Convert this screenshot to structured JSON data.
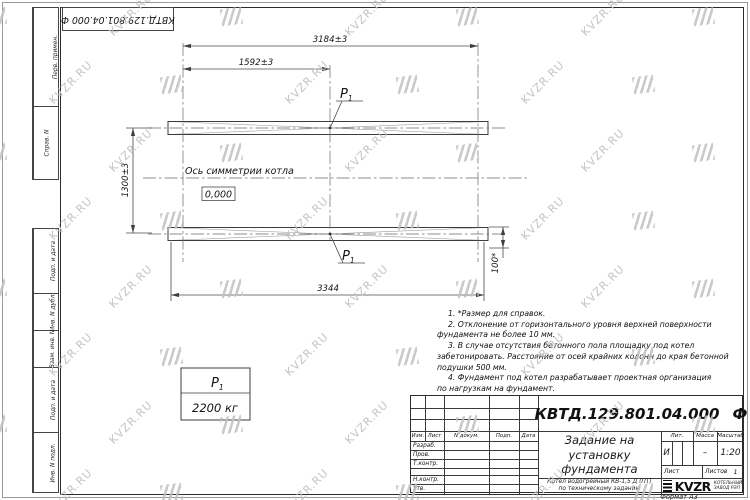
{
  "watermark": {
    "text": "KVZR.RU"
  },
  "stamp_top": "КВТД.129.801.04.000 Ф",
  "format_label": "Формат А3",
  "left_strip": {
    "items": [
      {
        "label": "Перв. примен."
      },
      {
        "label": "Справ. N"
      },
      {
        "label": "Подп. и дата"
      },
      {
        "label": "Инв. N дубл."
      },
      {
        "label": "Взам. инв. N"
      },
      {
        "label": "Подп. и дата"
      },
      {
        "label": "Инв. N подл."
      }
    ]
  },
  "drawing": {
    "dim_3184": "3184±3",
    "dim_1592": "1592±3",
    "dim_1300": "1300±3",
    "dim_3344": "3344",
    "dim_100": "100*",
    "axis_label": "Ось симметрии котла",
    "level_mark": "0,000",
    "load_sym": "P",
    "load_sub": "1",
    "load_value": "2200 кг"
  },
  "notes": {
    "lines": [
      {
        "text": "1. *Размер для справок."
      },
      {
        "text": "2. Отклонение от горизонтального уровня верхней поверхности"
      },
      {
        "text": "фундамента не более 10 мм."
      },
      {
        "text": "3. В случае отсутствия бетонного пола площадку под котел"
      },
      {
        "text": "забетонировать. Расстояние от осей крайних колонн до края бетонной"
      },
      {
        "text": "подушки 500 мм."
      },
      {
        "text": "4. Фундамент под котел разрабатывает проектная организация"
      },
      {
        "text": "по нагрузкам на фундамент."
      }
    ]
  },
  "title_block": {
    "designation": "КВТД.129.801.04.000",
    "designation_suffix": "Ф",
    "doc_title_lines": [
      "Задание на",
      "установку",
      "фундамента"
    ],
    "subtitle_lines": [
      "Котел водогрейный КВ-1,5 Д (ПТ)",
      "по техническому заданию"
    ],
    "header_cols": [
      "Изм.",
      "Лист",
      "N докум.",
      "Подп.",
      "Дата"
    ],
    "sign_rows": [
      "Разраб.",
      "Пров.",
      "Т.контр.",
      "",
      "Н.контр.",
      "Утв."
    ],
    "lit_label": "Лит.",
    "lit_value": "И",
    "mass_label": "Масса",
    "mass_value": "–",
    "scale_label": "Масштаб",
    "scale_value": "1:20",
    "sheet_label": "Лист",
    "sheets_label": "Листов",
    "sheets_value": "1",
    "logo_text": "KVZR",
    "company_lines": [
      "КОТЕЛЬНЫЙ",
      "ЗАВОД РЭП"
    ]
  }
}
